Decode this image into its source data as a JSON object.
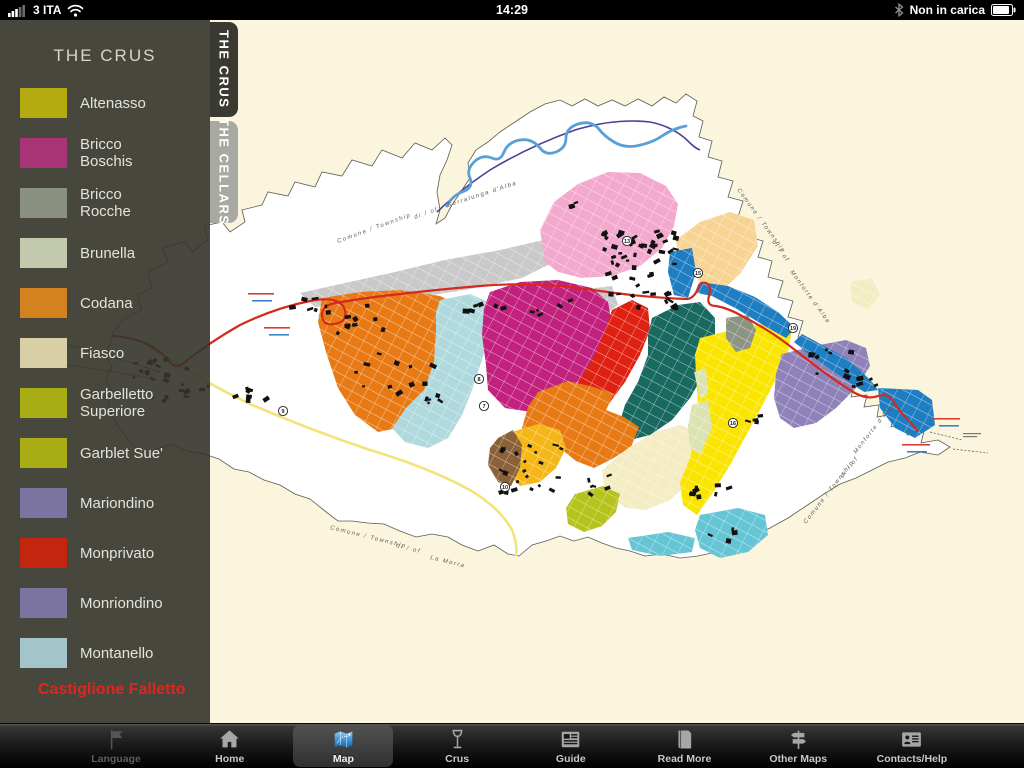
{
  "status_bar": {
    "carrier": "3 ITA",
    "time": "14:29",
    "battery_status": "Non in carica"
  },
  "sidebar": {
    "title": "THE CRUS",
    "footer": "Castiglione Falletto",
    "footer_color": "#e0261c",
    "items": [
      {
        "label": "Altenasso",
        "color": "#b2ac10"
      },
      {
        "label": "Bricco Boschis",
        "color": "#a83377"
      },
      {
        "label": "Bricco Rocche",
        "color": "#8a9181"
      },
      {
        "label": "Brunella",
        "color": "#c3c9ac"
      },
      {
        "label": "Codana",
        "color": "#d4811f"
      },
      {
        "label": "Fiasco",
        "color": "#d8cfa6"
      },
      {
        "label": "Garbelletto Superiore",
        "color": "#a9ad15"
      },
      {
        "label": "Garblet Sue'",
        "color": "#a9ad15"
      },
      {
        "label": "Mariondino",
        "color": "#7b74a1"
      },
      {
        "label": "Monprivato",
        "color": "#c2260f"
      },
      {
        "label": "Monriondino",
        "color": "#7b74a1"
      },
      {
        "label": "Montanello",
        "color": "#a3c4c8"
      }
    ]
  },
  "side_tabs": [
    {
      "label": "THE CRUS",
      "active": true
    },
    {
      "label": "THE CELLARS",
      "active": false
    }
  ],
  "tab_bar": {
    "items": [
      {
        "label": "Language",
        "icon": "flag",
        "disabled": true,
        "active": false
      },
      {
        "label": "Home",
        "icon": "home",
        "disabled": false,
        "active": false
      },
      {
        "label": "Map",
        "icon": "map",
        "disabled": false,
        "active": true
      },
      {
        "label": "Crus",
        "icon": "wine-glass",
        "disabled": false,
        "active": false
      },
      {
        "label": "Guide",
        "icon": "newspaper",
        "disabled": false,
        "active": false
      },
      {
        "label": "Read More",
        "icon": "book",
        "disabled": false,
        "active": false
      },
      {
        "label": "Other Maps",
        "icon": "signpost",
        "disabled": false,
        "active": false
      },
      {
        "label": "Contacts/Help",
        "icon": "contact-card",
        "disabled": false,
        "active": false
      }
    ]
  },
  "map": {
    "paper": "#fcf5de",
    "commune_fill": "#ffffff",
    "boundary_color": "#63635a",
    "river": {
      "light": "#5aa0d8",
      "dark": "#4a3f99"
    },
    "roads": {
      "red": "#d5291c",
      "yellow": "#f3e37b",
      "olive": "#8f8f3a"
    },
    "boundary_labels": [
      {
        "text": "Comune / Township",
        "x": 338,
        "y": 243,
        "rot": -20
      },
      {
        "text": "di / of",
        "x": 415,
        "y": 219,
        "rot": -20
      },
      {
        "text": "Serralunga d'Alba",
        "x": 448,
        "y": 207,
        "rot": -18
      },
      {
        "text": "Comune / Township",
        "x": 737,
        "y": 190,
        "rot": 54
      },
      {
        "text": "di / of",
        "x": 772,
        "y": 242,
        "rot": 54
      },
      {
        "text": "Monforte d'Alba",
        "x": 790,
        "y": 272,
        "rot": 54
      },
      {
        "text": "Comune / Township",
        "x": 330,
        "y": 529,
        "rot": 14
      },
      {
        "text": "di / of",
        "x": 396,
        "y": 547,
        "rot": 14
      },
      {
        "text": "La Morra",
        "x": 430,
        "y": 559,
        "rot": 14
      },
      {
        "text": "Comune / Township",
        "x": 806,
        "y": 524,
        "rot": -52
      },
      {
        "text": "di / of",
        "x": 843,
        "y": 478,
        "rot": -52
      },
      {
        "text": "Monforte d'Alba",
        "x": 856,
        "y": 454,
        "rot": -52
      }
    ],
    "markers": [
      {
        "n": "13",
        "x": 627,
        "y": 241
      },
      {
        "n": "15",
        "x": 698,
        "y": 273
      },
      {
        "n": "19",
        "x": 793,
        "y": 328
      },
      {
        "n": "8",
        "x": 479,
        "y": 379
      },
      {
        "n": "7",
        "x": 484,
        "y": 406
      },
      {
        "n": "10",
        "x": 505,
        "y": 487
      },
      {
        "n": "9",
        "x": 283,
        "y": 411
      },
      {
        "n": "16",
        "x": 733,
        "y": 423
      }
    ],
    "road_notes": [
      {
        "x": 248,
        "y": 293,
        "w": 26,
        "color": "#d5291c"
      },
      {
        "x": 252,
        "y": 300,
        "w": 20,
        "color": "#2277c8"
      },
      {
        "x": 264,
        "y": 327,
        "w": 26,
        "color": "#d5291c"
      },
      {
        "x": 269,
        "y": 334,
        "w": 20,
        "color": "#2277c8"
      },
      {
        "x": 934,
        "y": 418,
        "w": 26,
        "color": "#d5291c"
      },
      {
        "x": 939,
        "y": 425,
        "w": 20,
        "color": "#2277c8"
      },
      {
        "x": 902,
        "y": 444,
        "w": 28,
        "color": "#d5291c"
      },
      {
        "x": 907,
        "y": 451,
        "w": 20,
        "color": "#2277c8"
      }
    ],
    "regions": [
      {
        "name": "urban-gray-band",
        "color": "#c9c9c9",
        "points": "300,293 345,283 395,272 445,260 500,250 548,239 562,258 522,278 470,289 420,297 365,304 315,307"
      },
      {
        "name": "urban-gray-small",
        "color": "#c9c9c9",
        "points": "578,290 612,286 618,305 600,318 580,312"
      },
      {
        "name": "pink-region",
        "color": "#f3a8cd",
        "points": "545,262 540,230 554,202 578,184 608,172 640,173 666,186 678,204 674,226 662,248 640,266 612,276 582,278 558,272"
      },
      {
        "name": "peach-region",
        "color": "#f8d494",
        "points": "676,240 700,222 730,212 754,220 758,246 740,274 720,292 702,284 688,265 678,252"
      },
      {
        "name": "codana-orange-west",
        "color": "#e87a16",
        "points": "322,298 360,292 400,290 440,296 452,302 460,317 455,340 445,365 432,392 415,415 398,428 378,432 355,415 338,388 326,352 318,322"
      },
      {
        "name": "montanello-lightblue",
        "color": "#b0d9de",
        "points": "440,300 470,294 488,302 490,330 482,360 472,390 462,415 448,438 428,448 405,442 392,428 406,408 424,390 434,362 436,330 436,312"
      },
      {
        "name": "bricco-boschis-magenta",
        "color": "#c2227d",
        "points": "490,292 520,282 558,280 592,288 608,302 612,325 600,352 582,378 558,398 532,412 505,408 488,390 486,365 482,335 484,308"
      },
      {
        "name": "monprivato-red",
        "color": "#df2114",
        "points": "612,310 632,300 648,308 650,330 640,355 625,382 608,405 590,425 572,438 558,428 562,405 578,382 595,355 605,330"
      },
      {
        "name": "teal-region",
        "color": "#18695f",
        "points": "652,318 678,305 700,302 715,318 715,345 705,372 690,398 672,420 650,435 630,440 618,428 625,405 638,382 648,355 648,335"
      },
      {
        "name": "codana-orange-band",
        "color": "#e87a16",
        "points": "538,392 568,381 594,387 614,394 606,410 624,417 639,427 631,447 612,459 594,468 576,461 560,448 543,452 528,445 522,428 528,407"
      },
      {
        "name": "golden-region",
        "color": "#f5b717",
        "points": "512,432 538,424 560,430 566,448 556,468 540,482 520,486 506,472 502,452 504,440"
      },
      {
        "name": "brown-region",
        "color": "#8a6139",
        "points": "498,438 513,430 522,445 520,468 511,486 498,482 488,465 490,448"
      },
      {
        "name": "fiasco-pale",
        "color": "#f4ecc2",
        "points": "602,470 628,448 655,432 680,425 702,433 706,456 692,480 670,500 646,510 626,508 612,498 604,486"
      },
      {
        "name": "fiasco-pale-ne",
        "color": "#f4ecc2",
        "points": "850,282 872,278 880,295 868,310 852,302"
      },
      {
        "name": "garblet-chartreuse",
        "color": "#b5c31c",
        "points": "575,494 603,486 620,494 616,512 602,526 584,532 568,524 566,508"
      },
      {
        "name": "yellow-region",
        "color": "#fae500",
        "points": "700,338 740,328 775,322 792,330 788,352 778,375 764,402 748,432 730,465 712,494 697,515 683,505 680,483 690,458 696,432 698,405 696,375 695,355"
      },
      {
        "name": "mariondino-purple",
        "color": "#8f82ba",
        "points": "782,354 814,346 846,340 866,348 870,366 856,388 836,408 816,423 794,428 780,418 774,398 776,374"
      },
      {
        "name": "brunella-pale-green-a",
        "color": "#dce3b2",
        "points": "694,372 706,368 708,395 700,398"
      },
      {
        "name": "brunella-pale-green-b",
        "color": "#dce3b2",
        "points": "692,405 708,400 712,428 700,455 690,448 688,425"
      },
      {
        "name": "blue-village-patch",
        "color": "#1f7ec2",
        "points": "670,252 692,248 696,272 688,298 674,295 668,272"
      },
      {
        "name": "blue-band-north",
        "color": "#1f7ec2",
        "points": "700,282 728,286 755,297 778,312 795,328 786,338 763,325 737,309 712,296 697,293"
      },
      {
        "name": "blue-band-east",
        "color": "#1f7ec2",
        "points": "802,334 824,346 846,358 862,372 872,382 878,390 864,392 846,380 826,366 806,352 794,342"
      },
      {
        "name": "blue-triangle-tip",
        "color": "#1f7ec2",
        "points": "878,388 918,390 932,400 935,425 915,438 895,428 880,408"
      },
      {
        "name": "bricco-rocche-graygreen",
        "color": "#8d9484",
        "points": "726,318 748,315 756,330 750,348 736,352 726,338"
      },
      {
        "name": "cyan-bottom",
        "color": "#66c5d5",
        "points": "700,515 738,508 765,515 768,535 748,552 720,558 700,548 695,530"
      },
      {
        "name": "cyan-strip",
        "color": "#66c5d5",
        "points": "628,538 668,532 695,538 692,552 660,556 632,550"
      }
    ],
    "building_clusters": [
      {
        "cx": 640,
        "cy": 268,
        "w": 80,
        "h": 78,
        "n": 55
      },
      {
        "cx": 172,
        "cy": 378,
        "w": 88,
        "h": 42,
        "n": 24
      },
      {
        "cx": 392,
        "cy": 374,
        "w": 95,
        "h": 72,
        "n": 16
      },
      {
        "cx": 352,
        "cy": 318,
        "w": 62,
        "h": 30,
        "n": 10
      },
      {
        "cx": 483,
        "cy": 302,
        "w": 42,
        "h": 22,
        "n": 6
      },
      {
        "cx": 548,
        "cy": 309,
        "w": 42,
        "h": 20,
        "n": 5
      },
      {
        "cx": 534,
        "cy": 466,
        "w": 72,
        "h": 50,
        "n": 22
      },
      {
        "cx": 598,
        "cy": 482,
        "w": 32,
        "h": 20,
        "n": 6
      },
      {
        "cx": 707,
        "cy": 488,
        "w": 42,
        "h": 24,
        "n": 8
      },
      {
        "cx": 824,
        "cy": 363,
        "w": 58,
        "h": 28,
        "n": 9
      },
      {
        "cx": 864,
        "cy": 381,
        "w": 30,
        "h": 16,
        "n": 5
      },
      {
        "cx": 746,
        "cy": 421,
        "w": 28,
        "h": 15,
        "n": 4
      },
      {
        "cx": 719,
        "cy": 533,
        "w": 30,
        "h": 13,
        "n": 4
      },
      {
        "cx": 577,
        "cy": 206,
        "w": 20,
        "h": 11,
        "n": 3
      },
      {
        "cx": 305,
        "cy": 300,
        "w": 40,
        "h": 20,
        "n": 6
      },
      {
        "cx": 253,
        "cy": 395,
        "w": 50,
        "h": 26,
        "n": 8
      }
    ]
  }
}
